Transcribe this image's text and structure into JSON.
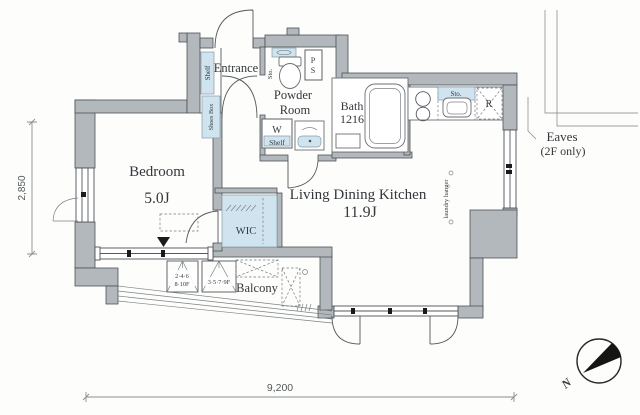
{
  "rooms": {
    "bedroom": {
      "name": "Bedroom",
      "area": "5.0J"
    },
    "living_dining_kitchen": {
      "name": "Living Dining Kitchen",
      "area": "11.9J"
    },
    "wic": {
      "name": "WIC"
    },
    "entrance": {
      "name": "Entrance"
    },
    "powder_room": {
      "name_line1": "Powder",
      "name_line2": "Room"
    },
    "bath": {
      "name": "Bath",
      "size": "1216"
    },
    "balcony": {
      "name": "Balcony"
    }
  },
  "fixtures": {
    "entrance_shelf": "Shelf",
    "shoes_box": "Shoes Box",
    "toilet_storage": "Sto.",
    "pipe_space_p": "P",
    "pipe_space_s": "S",
    "washer_space": "W",
    "washer_shelf": "Shelf",
    "kitchen_storage": "Sto.",
    "refrigerator": "R",
    "laundry_hanger": "laundry hanger"
  },
  "balcony_hatches": {
    "hatch_a_line1": "2·4·6",
    "hatch_a_line2": "8·10F",
    "hatch_b": "3·5·7·9F"
  },
  "annotations": {
    "eaves_line1": "Eaves",
    "eaves_line2": "(2F only)",
    "north_mark": "N"
  },
  "dimensions": {
    "vertical": "2,850",
    "horizontal": "9,200"
  },
  "colors": {
    "wall_fill": "#b3b8bd",
    "wall_outline": "#4e5257",
    "accent_blue": "#cfe4ef",
    "line": "#5a5e62",
    "text": "#34383c"
  }
}
